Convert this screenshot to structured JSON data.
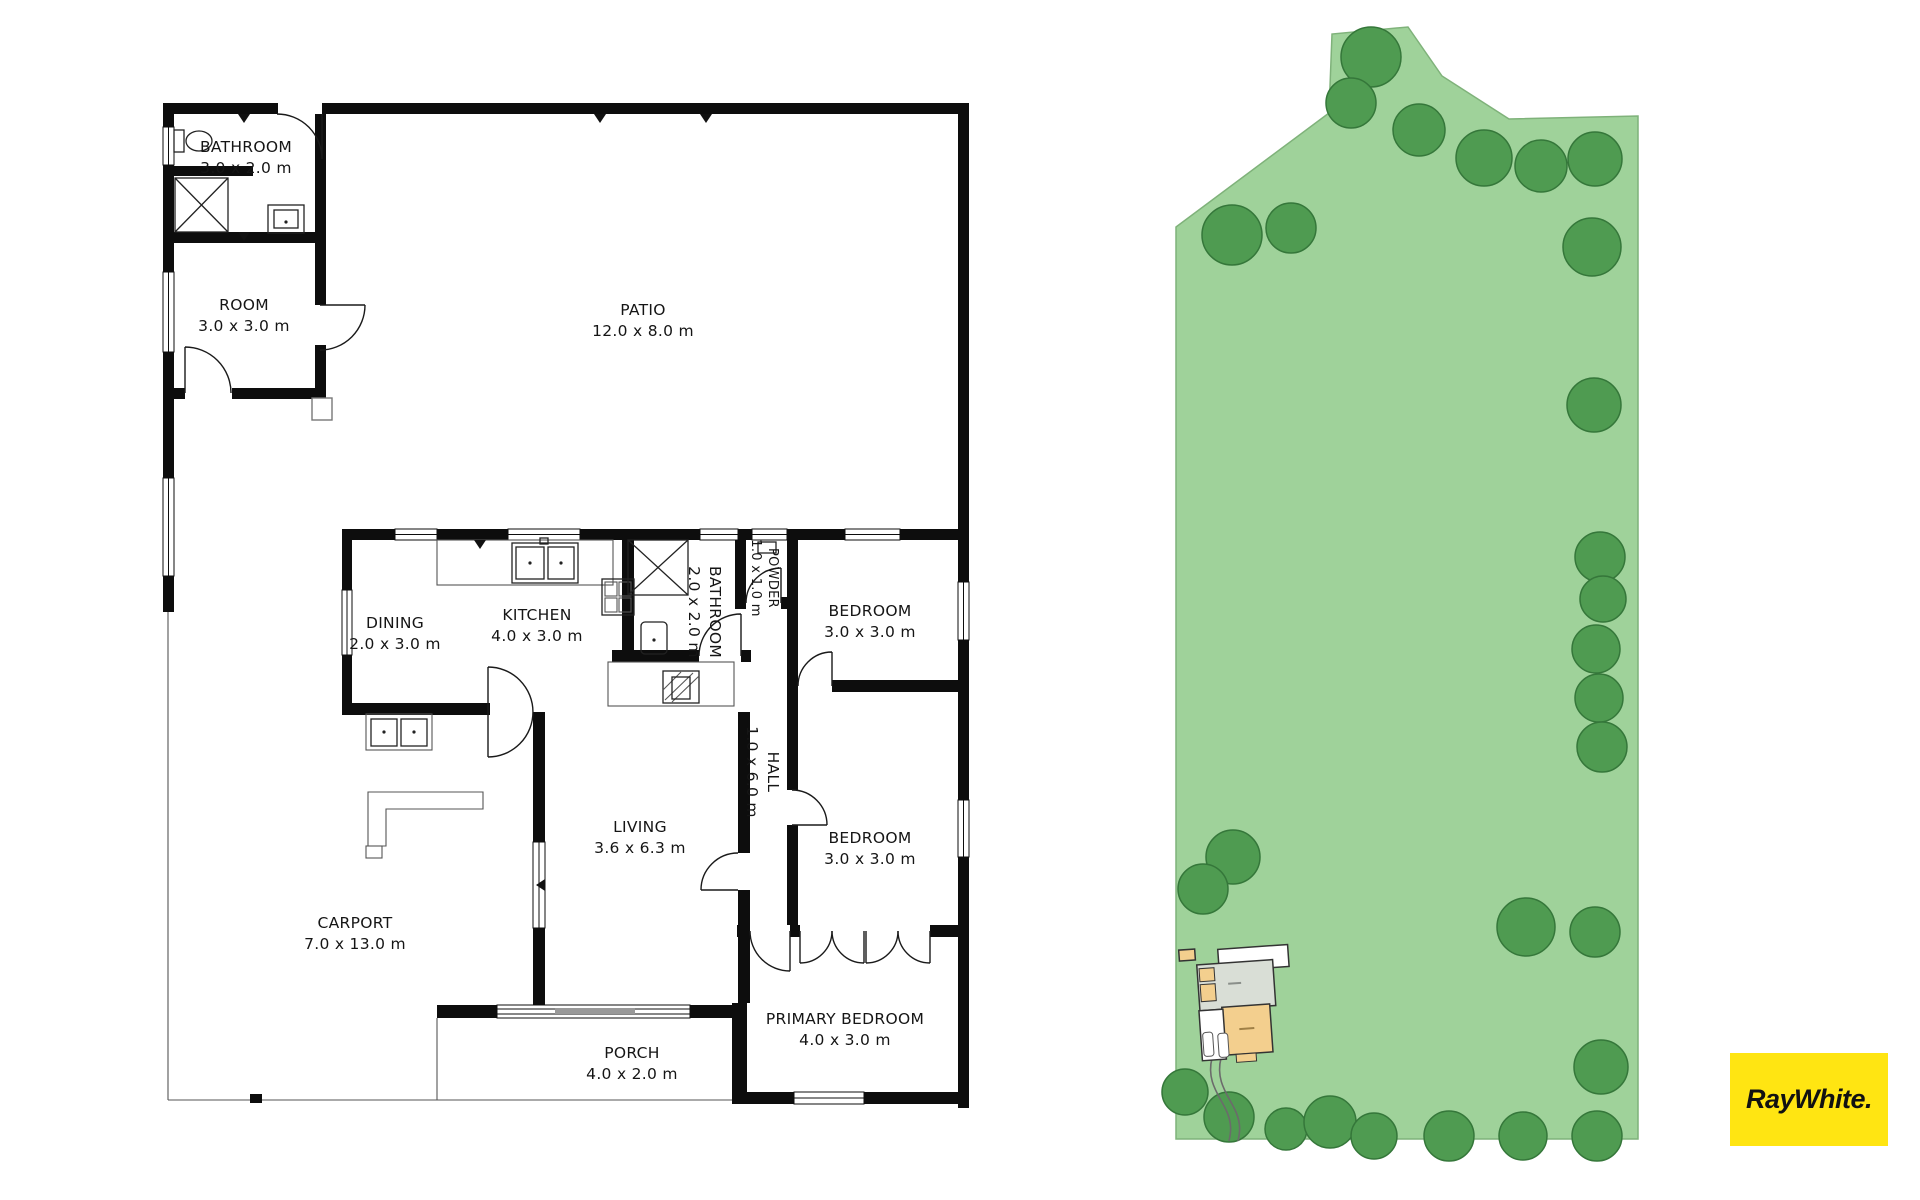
{
  "floor_plan": {
    "rooms": [
      {
        "id": "bathroom-upper",
        "name": "BATHROOM",
        "dims": "3.0 x 2.0 m"
      },
      {
        "id": "room",
        "name": "ROOM",
        "dims": "3.0 x 3.0 m"
      },
      {
        "id": "patio",
        "name": "PATIO",
        "dims": "12.0 x 8.0 m"
      },
      {
        "id": "dining",
        "name": "DINING",
        "dims": "2.0 x 3.0 m"
      },
      {
        "id": "kitchen",
        "name": "KITCHEN",
        "dims": "4.0 x 3.0 m"
      },
      {
        "id": "bathroom",
        "name": "BATHROOM",
        "dims": "2.0 x 2.0 m"
      },
      {
        "id": "powder",
        "name": "POWDER",
        "dims": "1.0 x 1.0 m"
      },
      {
        "id": "bedroom-1",
        "name": "BEDROOM",
        "dims": "3.0 x 3.0 m"
      },
      {
        "id": "hall",
        "name": "HALL",
        "dims": "1.0 x 6.0 m"
      },
      {
        "id": "bedroom-2",
        "name": "BEDROOM",
        "dims": "3.0 x 3.0 m"
      },
      {
        "id": "living",
        "name": "LIVING",
        "dims": "3.6 x 6.3 m"
      },
      {
        "id": "carport",
        "name": "CARPORT",
        "dims": "7.0 x 13.0 m"
      },
      {
        "id": "porch",
        "name": "PORCH",
        "dims": "4.0 x 2.0 m"
      },
      {
        "id": "primary-bedroom",
        "name": "PRIMARY BEDROOM",
        "dims": "4.0 x 3.0 m"
      }
    ]
  },
  "site_plan": {
    "lawn_color": "#9fd29a",
    "lawn_edge_color": "#7fb27a",
    "tree_color": "#4f9b51",
    "tree_edge_color": "#35773a",
    "house_roof_color": "#f3cf8e",
    "patio_color": "#d9ded6",
    "driveway_color": "#6b6b6b"
  },
  "branding": {
    "logo_text": "RayWhite.",
    "logo_bg": "#ffe512",
    "logo_text_color": "#111111"
  }
}
